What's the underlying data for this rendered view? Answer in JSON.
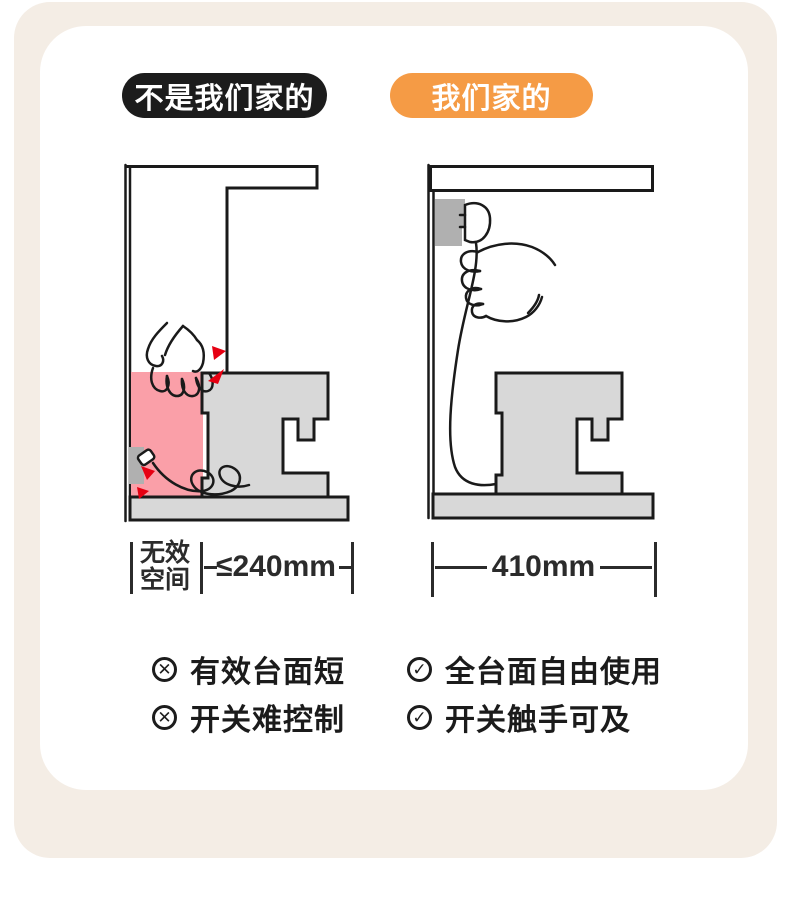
{
  "badges": {
    "left": {
      "label": "不是我们家的",
      "bg": "#1C1C1C",
      "color": "#FFFFFF"
    },
    "right": {
      "label": "我们家的",
      "bg": "#F59B45",
      "color": "#FFFFFF"
    }
  },
  "measurements": {
    "left": {
      "zone_line1": "无效",
      "zone_line2": "空间",
      "value": "≤240mm"
    },
    "right": {
      "value": "410mm"
    }
  },
  "bullets": {
    "left": [
      {
        "icon": "✕",
        "label": "有效台面短"
      },
      {
        "icon": "✕",
        "label": "开关难控制"
      }
    ],
    "right": [
      {
        "icon": "✓",
        "label": "全台面自由使用"
      },
      {
        "icon": "✓",
        "label": "开关触手可及"
      }
    ]
  },
  "colors": {
    "panel_beige": "#F4EDE5",
    "card_white": "#FFFFFF",
    "badge_black": "#1C1C1C",
    "accent_orange": "#F59B45",
    "dead_space_pink": "#FA9FA8",
    "appliance_gray": "#D8D8D8",
    "outlet_gray": "#B0B0B0",
    "outline_black": "#1A1A1A",
    "warning_red": "#E60012",
    "text_dark": "#2B2B2B"
  }
}
